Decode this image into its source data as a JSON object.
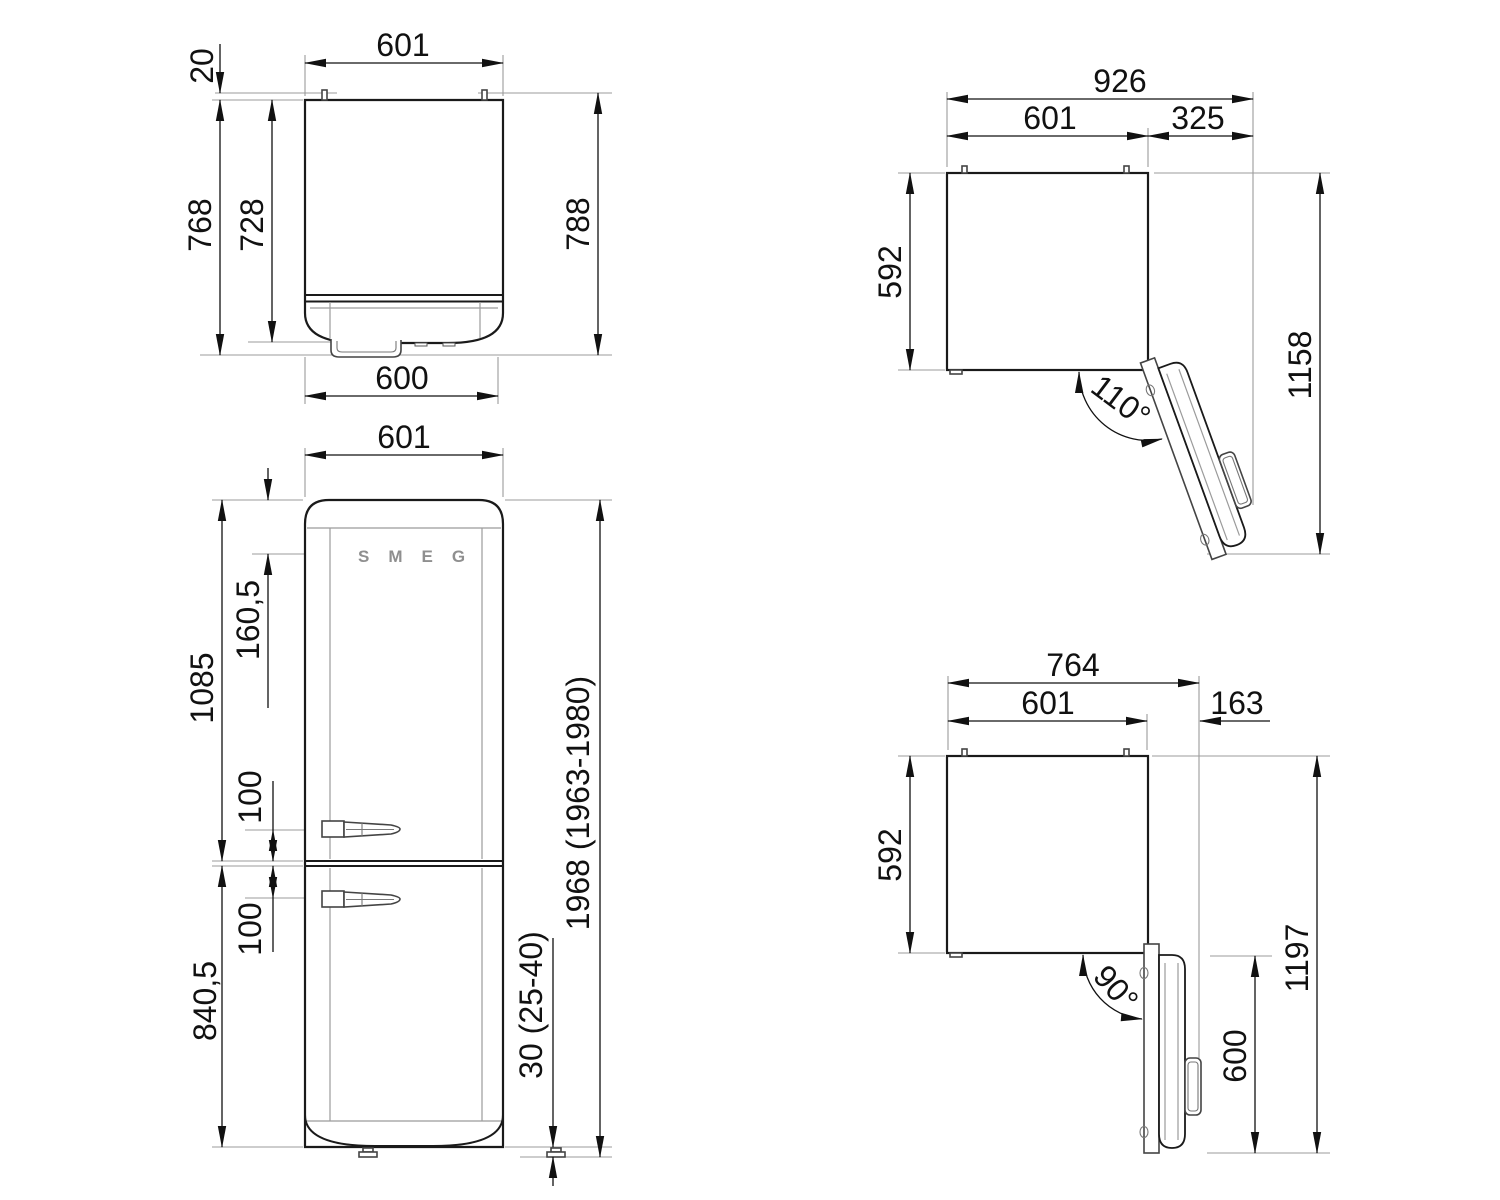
{
  "views": {
    "top": {
      "dims": {
        "width_top": "601",
        "hinge_offset": "20",
        "depth_with_handle": "768",
        "depth_body": "728",
        "depth_total": "788",
        "width_bottom": "600"
      }
    },
    "front": {
      "logo": "SMEG",
      "dims": {
        "width": "601",
        "logo_offset": "160,5",
        "upper_height": "1085",
        "handle_gap_upper": "100",
        "handle_gap_lower": "100",
        "lower_height": "840,5",
        "total_height": "1968 (1963-1980)",
        "feet_height": "30 (25-40)"
      }
    },
    "open110": {
      "dims": {
        "overall_width": "926",
        "body_width": "601",
        "clearance": "325",
        "depth": "592",
        "overall_depth": "1158",
        "angle": "110°"
      }
    },
    "open90": {
      "dims": {
        "overall_width": "764",
        "body_width": "601",
        "clearance": "163",
        "depth": "592",
        "door_width": "600",
        "overall_depth": "1197",
        "angle": "90°"
      }
    }
  }
}
